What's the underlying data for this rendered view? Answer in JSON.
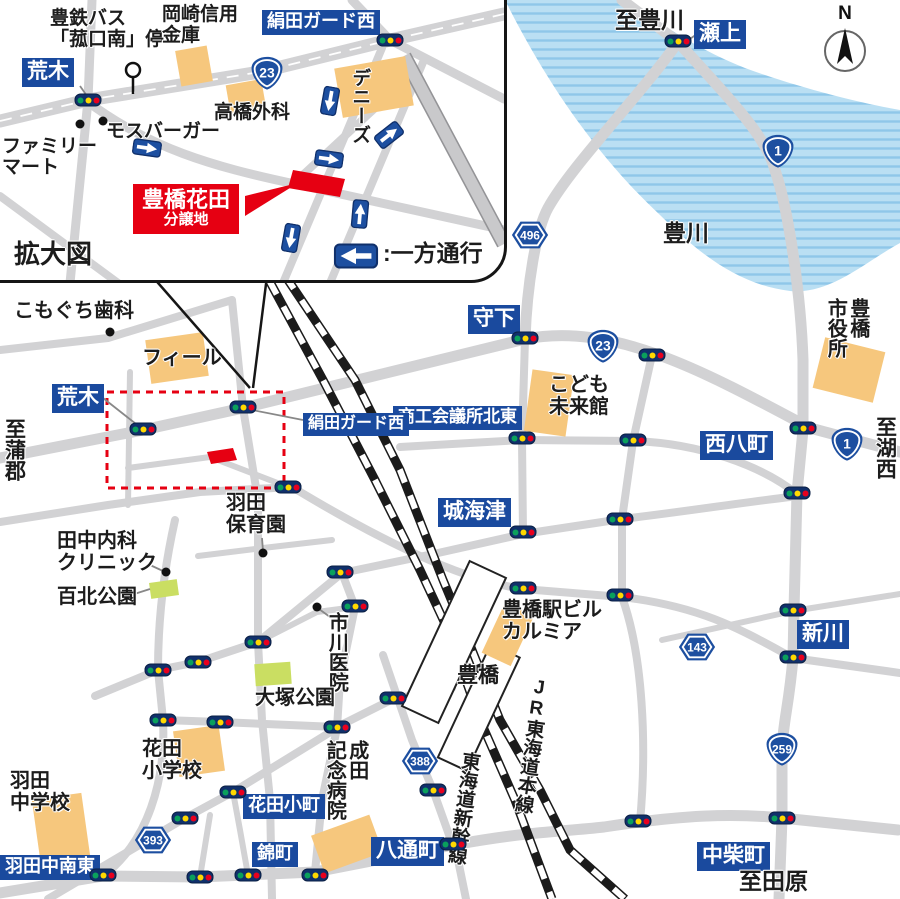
{
  "colors": {
    "sign_bg": "#1a4a9e",
    "shield_blue": "#1d4fa0",
    "accent_red": "#e60012",
    "building_orange": "#f6c77d",
    "park_green": "#cade62",
    "road_gray": "#d2d2d4",
    "river_blue": "#badff3",
    "river_stripe": "#8fc7e9",
    "railway_black": "#1b1b1b"
  },
  "compass": {
    "label": "N"
  },
  "inset": {
    "caption": "拡大図",
    "callout": {
      "name": "hanada-site-callout",
      "line1": "豊橋花田",
      "line2": "分譲地"
    },
    "labels": [
      {
        "name": "bus-stop-label",
        "type": "text",
        "text": "豊鉄バス\n「菰口南」停",
        "x": 50,
        "y": 8,
        "fs": 19
      },
      {
        "name": "okazaki-shinkin-label",
        "type": "text",
        "text": "岡崎信用\n金庫",
        "x": 162,
        "y": 4,
        "fs": 19
      },
      {
        "name": "kinuta-guard-west-sign-inset",
        "type": "sign",
        "text": "絹田ガード西",
        "x": 262,
        "y": 10,
        "fs": 18
      },
      {
        "name": "araki-sign-inset",
        "type": "sign",
        "text": "荒木",
        "x": 22,
        "y": 58,
        "fs": 21
      },
      {
        "name": "familymart-label",
        "type": "text",
        "text": "ファミリー\nマート",
        "x": 2,
        "y": 136,
        "fs": 19
      },
      {
        "name": "mos-burger-label",
        "type": "text",
        "text": "モスバーガー",
        "x": 106,
        "y": 121,
        "fs": 19
      },
      {
        "name": "takahashi-clinic-label",
        "type": "text",
        "text": "高橋外科",
        "x": 214,
        "y": 102,
        "fs": 19
      },
      {
        "name": "dennys-label",
        "type": "text-v",
        "text": "デニーズ",
        "x": 349,
        "y": 68,
        "fs": 19
      },
      {
        "name": "kakudaizu-caption",
        "type": "text",
        "text": "拡大図",
        "x": 14,
        "y": 240,
        "fs": 26
      },
      {
        "name": "oneway-legend-text",
        "type": "text",
        "text": ":一方通行",
        "x": 383,
        "y": 241,
        "fs": 23
      }
    ],
    "shields": [
      {
        "name": "route-23-shield-inset",
        "kind": "national",
        "num": "23",
        "x": 267,
        "y": 73
      }
    ],
    "lights": [
      [
        88,
        100
      ],
      [
        390,
        40
      ]
    ],
    "arrows": [
      {
        "name": "oneway-arrow-1",
        "x": 330,
        "y": 101,
        "rot": 100
      },
      {
        "name": "oneway-arrow-2",
        "x": 389,
        "y": 135,
        "rot": -38
      },
      {
        "name": "oneway-arrow-3",
        "x": 329,
        "y": 159,
        "rot": 8
      },
      {
        "name": "oneway-arrow-4",
        "x": 147,
        "y": 148,
        "rot": 8
      },
      {
        "name": "oneway-arrow-5",
        "x": 360,
        "y": 214,
        "rot": -85
      },
      {
        "name": "oneway-arrow-6",
        "x": 291,
        "y": 238,
        "rot": 100
      },
      {
        "name": "oneway-legend-arrow",
        "x": 356,
        "y": 256,
        "rot": 180,
        "legend": true
      }
    ],
    "pois": [
      [
        80,
        124
      ],
      [
        103,
        121
      ]
    ]
  },
  "map": {
    "labels": [
      {
        "name": "to-toyokawa-label",
        "type": "text",
        "text": "至豊川",
        "x": 615,
        "y": 8,
        "fs": 23
      },
      {
        "name": "segami-sign",
        "type": "sign",
        "text": "瀬上",
        "x": 694,
        "y": 20,
        "fs": 21
      },
      {
        "name": "toyokawa-river-label",
        "type": "text",
        "text": "豊川",
        "x": 663,
        "y": 221,
        "fs": 23
      },
      {
        "name": "morishita-sign",
        "type": "sign",
        "text": "守下",
        "x": 468,
        "y": 305,
        "fs": 21
      },
      {
        "name": "kodomo-mirai-label",
        "type": "text",
        "text": "こども\n未来館",
        "x": 549,
        "y": 374,
        "fs": 20
      },
      {
        "name": "city-hall-label",
        "type": "text-v",
        "text": "豊橋\n市役所",
        "x": 824,
        "y": 298,
        "fs": 20
      },
      {
        "name": "to-kosai-label",
        "type": "text-v",
        "text": "至湖西",
        "x": 873,
        "y": 416,
        "fs": 21
      },
      {
        "name": "nishihatcho-sign",
        "type": "sign",
        "text": "西八町",
        "x": 700,
        "y": 431,
        "fs": 21
      },
      {
        "name": "shoko-kaigisho-sign",
        "type": "sign",
        "text": "商工会議所北東",
        "x": 393,
        "y": 406,
        "fs": 17
      },
      {
        "name": "shirokaizu-sign",
        "type": "sign",
        "text": "城海津",
        "x": 438,
        "y": 498,
        "fs": 21
      },
      {
        "name": "kinuta-guard-west-sign",
        "type": "sign",
        "text": "絹田ガード西",
        "x": 303,
        "y": 413,
        "fs": 16
      },
      {
        "name": "araki-sign",
        "type": "sign",
        "text": "荒木",
        "x": 52,
        "y": 384,
        "fs": 21
      },
      {
        "name": "to-gamagori-label",
        "type": "text-v",
        "text": "至蒲郡",
        "x": 2,
        "y": 418,
        "fs": 21
      },
      {
        "name": "komoguchi-dental-label",
        "type": "text",
        "text": "こもぐち歯科",
        "x": 14,
        "y": 300,
        "fs": 20
      },
      {
        "name": "feel-label",
        "type": "text",
        "text": "フィール",
        "x": 142,
        "y": 347,
        "fs": 20
      },
      {
        "name": "tanaka-clinic-label",
        "type": "text",
        "text": "田中内科\nクリニック",
        "x": 57,
        "y": 530,
        "fs": 20
      },
      {
        "name": "hyakukita-park-label",
        "type": "text",
        "text": "百北公園",
        "x": 57,
        "y": 586,
        "fs": 20
      },
      {
        "name": "haneda-nursery-label",
        "type": "text",
        "text": "羽田\n保育園",
        "x": 226,
        "y": 492,
        "fs": 20
      },
      {
        "name": "ichikawa-clinic-label",
        "type": "text-v",
        "text": "市川医院",
        "x": 325,
        "y": 612,
        "fs": 20
      },
      {
        "name": "otsuka-park-label",
        "type": "text",
        "text": "大塚公園",
        "x": 255,
        "y": 687,
        "fs": 20
      },
      {
        "name": "station-building-label",
        "type": "text",
        "text": "豊橋駅ビル\nカルミア",
        "x": 502,
        "y": 599,
        "fs": 20
      },
      {
        "name": "toyohashi-station-label",
        "type": "text",
        "text": "豊橋",
        "x": 457,
        "y": 664,
        "fs": 21
      },
      {
        "name": "jr-tokaido-line-label",
        "type": "text-v",
        "text": "JR東海道本線",
        "x": 530,
        "y": 676,
        "fs": 19,
        "rot": 8,
        "upright": true
      },
      {
        "name": "tokaido-shinkansen-label",
        "type": "text-v",
        "text": "東海道新幹線",
        "x": 460,
        "y": 750,
        "fs": 19,
        "rot": 8
      },
      {
        "name": "shinkawa-sign",
        "type": "sign",
        "text": "新川",
        "x": 797,
        "y": 620,
        "fs": 21
      },
      {
        "name": "nakashiba-sign",
        "type": "sign",
        "text": "中柴町",
        "x": 697,
        "y": 842,
        "fs": 21
      },
      {
        "name": "to-tahara-label",
        "type": "text",
        "text": "至田原",
        "x": 739,
        "y": 869,
        "fs": 23
      },
      {
        "name": "hattori-cho-sign",
        "type": "sign",
        "text": "八通町",
        "x": 371,
        "y": 837,
        "fs": 21
      },
      {
        "name": "narita-hospital-label",
        "type": "text-v",
        "text": "成田\n記念病院",
        "x": 323,
        "y": 740,
        "fs": 20
      },
      {
        "name": "hanada-elementary-label",
        "type": "text",
        "text": "花田\n小学校",
        "x": 142,
        "y": 738,
        "fs": 20
      },
      {
        "name": "haneda-jhs-label",
        "type": "text",
        "text": "羽田\n中学校",
        "x": 10,
        "y": 770,
        "fs": 20
      },
      {
        "name": "haneda-naka-nanto-sign",
        "type": "sign",
        "text": "羽田中南東",
        "x": 0,
        "y": 855,
        "fs": 18
      },
      {
        "name": "hanada-komachi-sign",
        "type": "sign",
        "text": "花田小町",
        "x": 243,
        "y": 794,
        "fs": 18
      },
      {
        "name": "nishiki-cho-sign",
        "type": "sign",
        "text": "錦町",
        "x": 252,
        "y": 842,
        "fs": 18
      }
    ],
    "shields": [
      {
        "name": "route-1-shield-north",
        "kind": "national",
        "num": "1",
        "x": 778,
        "y": 151
      },
      {
        "name": "route-496-shield",
        "kind": "pref",
        "num": "496",
        "x": 530,
        "y": 235
      },
      {
        "name": "route-23-shield",
        "kind": "national",
        "num": "23",
        "x": 603,
        "y": 346
      },
      {
        "name": "route-1-shield-east",
        "kind": "national",
        "num": "1",
        "x": 847,
        "y": 444
      },
      {
        "name": "route-143-shield",
        "kind": "pref",
        "num": "143",
        "x": 697,
        "y": 647
      },
      {
        "name": "route-259-shield",
        "kind": "national",
        "num": "259",
        "x": 782,
        "y": 749
      },
      {
        "name": "route-388-shield",
        "kind": "pref",
        "num": "388",
        "x": 420,
        "y": 761
      },
      {
        "name": "route-393-shield",
        "kind": "pref",
        "num": "393",
        "x": 153,
        "y": 840
      }
    ],
    "lights": [
      [
        678,
        41
      ],
      [
        143,
        429
      ],
      [
        243,
        407
      ],
      [
        288,
        487
      ],
      [
        525,
        338
      ],
      [
        652,
        355
      ],
      [
        522,
        438
      ],
      [
        633,
        440
      ],
      [
        803,
        428
      ],
      [
        797,
        493
      ],
      [
        523,
        532
      ],
      [
        620,
        519
      ],
      [
        523,
        588
      ],
      [
        620,
        595
      ],
      [
        793,
        610
      ],
      [
        793,
        657
      ],
      [
        340,
        572
      ],
      [
        355,
        606
      ],
      [
        258,
        642
      ],
      [
        198,
        662
      ],
      [
        158,
        670
      ],
      [
        163,
        720
      ],
      [
        220,
        722
      ],
      [
        337,
        727
      ],
      [
        393,
        698
      ],
      [
        233,
        792
      ],
      [
        185,
        818
      ],
      [
        103,
        875
      ],
      [
        200,
        877
      ],
      [
        248,
        875
      ],
      [
        315,
        875
      ],
      [
        433,
        790
      ],
      [
        453,
        844
      ],
      [
        638,
        821
      ],
      [
        782,
        818
      ]
    ],
    "pois": [
      [
        110,
        332
      ],
      [
        166,
        572
      ],
      [
        263,
        553
      ],
      [
        317,
        607
      ]
    ]
  }
}
